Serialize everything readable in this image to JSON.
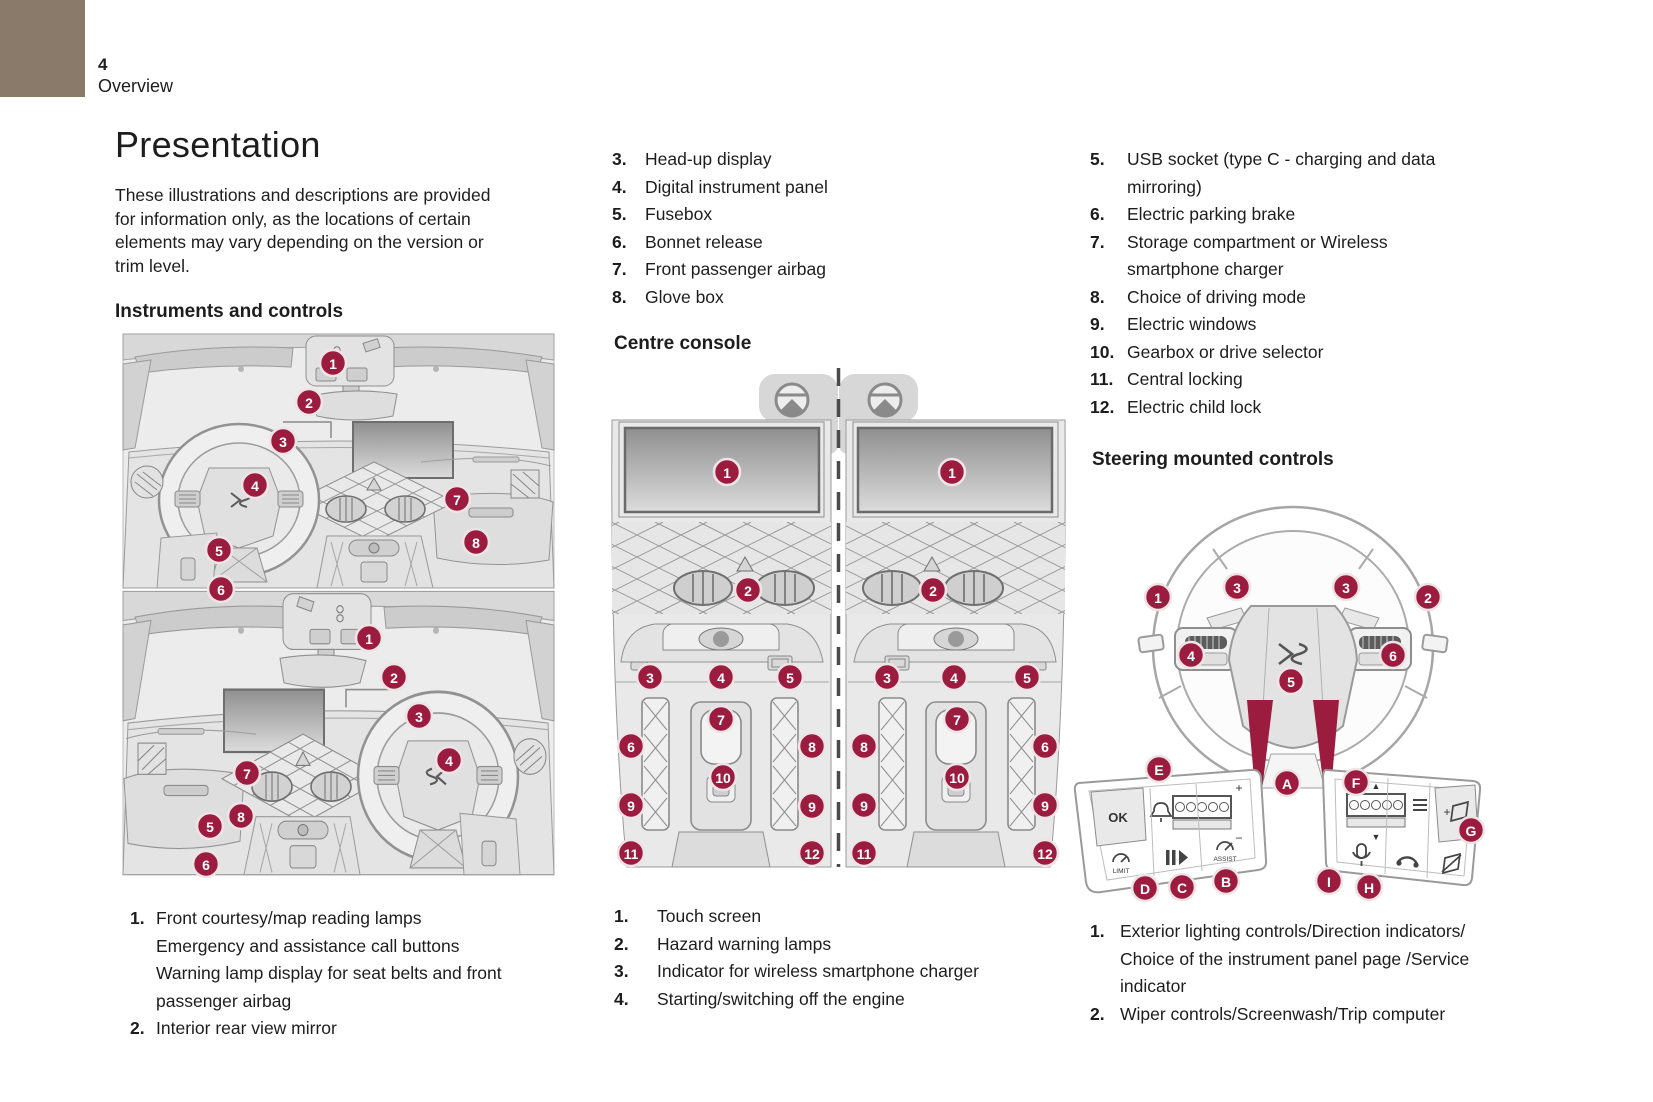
{
  "page": {
    "number": "4",
    "section": "Overview",
    "title": "Presentation",
    "intro": "These illustrations and descriptions are provided\nfor information only, as the locations of certain\nelements may vary depending on the version or\ntrim level.",
    "accent_color": "#9c1c40",
    "corner_color": "#8a7a69"
  },
  "instruments": {
    "heading": "Instruments and controls",
    "legend": [
      {
        "num": "1.",
        "text": "Front courtesy/map reading lamps\nEmergency and assistance call buttons\nWarning lamp display for seat belts and front\npassenger airbag"
      },
      {
        "num": "2.",
        "text": "Interior rear view mirror"
      }
    ],
    "callouts_top": [
      {
        "t": "1",
        "x": 212,
        "y": 33
      },
      {
        "t": "2",
        "x": 188,
        "y": 72
      },
      {
        "t": "3",
        "x": 162,
        "y": 111
      },
      {
        "t": "4",
        "x": 134,
        "y": 155
      },
      {
        "t": "5",
        "x": 98,
        "y": 220
      },
      {
        "t": "6",
        "x": 100,
        "y": 259
      },
      {
        "t": "7",
        "x": 336,
        "y": 169
      },
      {
        "t": "8",
        "x": 355,
        "y": 212
      }
    ],
    "callouts_bottom": [
      {
        "t": "1",
        "x": 248,
        "y": 308
      },
      {
        "t": "2",
        "x": 273,
        "y": 347
      },
      {
        "t": "3",
        "x": 298,
        "y": 386
      },
      {
        "t": "4",
        "x": 328,
        "y": 430
      },
      {
        "t": "5",
        "x": 89,
        "y": 496
      },
      {
        "t": "6",
        "x": 85,
        "y": 534
      },
      {
        "t": "7",
        "x": 126,
        "y": 443
      },
      {
        "t": "8",
        "x": 120,
        "y": 486
      }
    ]
  },
  "dash_list": [
    {
      "num": "3.",
      "text": "Head-up display"
    },
    {
      "num": "4.",
      "text": "Digital instrument panel"
    },
    {
      "num": "5.",
      "text": "Fusebox"
    },
    {
      "num": "6.",
      "text": "Bonnet release"
    },
    {
      "num": "7.",
      "text": "Front passenger airbag"
    },
    {
      "num": "8.",
      "text": "Glove box"
    }
  ],
  "console": {
    "heading": "Centre console",
    "legend": [
      {
        "num": "1.",
        "text": "Touch screen"
      },
      {
        "num": "2.",
        "text": "Hazard warning lamps"
      },
      {
        "num": "3.",
        "text": "Indicator for wireless smartphone charger"
      },
      {
        "num": "4.",
        "text": "Starting/switching off the engine"
      }
    ],
    "callouts": [
      {
        "t": "1",
        "x": 132,
        "y": 110
      },
      {
        "t": "2",
        "x": 153,
        "y": 228
      },
      {
        "t": "3",
        "x": 55,
        "y": 315
      },
      {
        "t": "4",
        "x": 126,
        "y": 315
      },
      {
        "t": "5",
        "x": 195,
        "y": 315
      },
      {
        "t": "6",
        "x": 36,
        "y": 384
      },
      {
        "t": "7",
        "x": 126,
        "y": 357
      },
      {
        "t": "8",
        "x": 217,
        "y": 384
      },
      {
        "t": "9",
        "x": 36,
        "y": 443
      },
      {
        "t": "9",
        "x": 217,
        "y": 444
      },
      {
        "t": "10",
        "x": 128,
        "y": 415
      },
      {
        "t": "11",
        "x": 36,
        "y": 491
      },
      {
        "t": "12",
        "x": 217,
        "y": 491
      },
      {
        "t": "1",
        "x": 357,
        "y": 110
      },
      {
        "t": "2",
        "x": 338,
        "y": 228
      },
      {
        "t": "3",
        "x": 292,
        "y": 315
      },
      {
        "t": "4",
        "x": 359,
        "y": 315
      },
      {
        "t": "5",
        "x": 432,
        "y": 315
      },
      {
        "t": "6",
        "x": 450,
        "y": 384
      },
      {
        "t": "7",
        "x": 362,
        "y": 357
      },
      {
        "t": "8",
        "x": 269,
        "y": 384
      },
      {
        "t": "9",
        "x": 269,
        "y": 443
      },
      {
        "t": "9",
        "x": 450,
        "y": 443
      },
      {
        "t": "10",
        "x": 362,
        "y": 415
      },
      {
        "t": "11",
        "x": 269,
        "y": 491
      },
      {
        "t": "12",
        "x": 450,
        "y": 491
      }
    ]
  },
  "right_list": [
    {
      "num": "5.",
      "text": "USB socket (type C - charging and data\nmirroring)"
    },
    {
      "num": "6.",
      "text": "Electric parking brake"
    },
    {
      "num": "7.",
      "text": "Storage compartment or Wireless\nsmartphone charger"
    },
    {
      "num": "8.",
      "text": "Choice of driving mode"
    },
    {
      "num": "9.",
      "text": "Electric windows"
    },
    {
      "num": "10.",
      "text": "Gearbox or drive selector"
    },
    {
      "num": "11.",
      "text": "Central locking"
    },
    {
      "num": "12.",
      "text": "Electric child lock"
    }
  ],
  "steering": {
    "heading": "Steering mounted controls",
    "legend": [
      {
        "num": "1.",
        "text": "Exterior lighting controls/Direction indicators/\nChoice of the instrument panel page /Service\nindicator"
      },
      {
        "num": "2.",
        "text": "Wiper controls/Screenwash/Trip computer"
      }
    ],
    "callouts": [
      {
        "t": "1",
        "x": 103,
        "y": 119
      },
      {
        "t": "3",
        "x": 182,
        "y": 109
      },
      {
        "t": "3",
        "x": 291,
        "y": 109
      },
      {
        "t": "2",
        "x": 373,
        "y": 119
      },
      {
        "t": "4",
        "x": 136,
        "y": 177
      },
      {
        "t": "6",
        "x": 338,
        "y": 177
      },
      {
        "t": "5",
        "x": 236,
        "y": 203
      },
      {
        "t": "E",
        "x": 104,
        "y": 291
      },
      {
        "t": "A",
        "x": 232,
        "y": 305
      },
      {
        "t": "F",
        "x": 301,
        "y": 304
      },
      {
        "t": "G",
        "x": 416,
        "y": 352
      },
      {
        "t": "D",
        "x": 90,
        "y": 410
      },
      {
        "t": "C",
        "x": 127,
        "y": 409
      },
      {
        "t": "B",
        "x": 171,
        "y": 403
      },
      {
        "t": "I",
        "x": 274,
        "y": 403
      },
      {
        "t": "H",
        "x": 314,
        "y": 409
      }
    ],
    "pad_labels": {
      "ok": "OK",
      "limit": "LIMIT",
      "assist": "ASSIST"
    }
  },
  "icons": {
    "scroll_up": "▲",
    "scroll_down": "▼",
    "rotate_plus": "+",
    "rotate_minus": "−",
    "volume_plus": "+"
  }
}
